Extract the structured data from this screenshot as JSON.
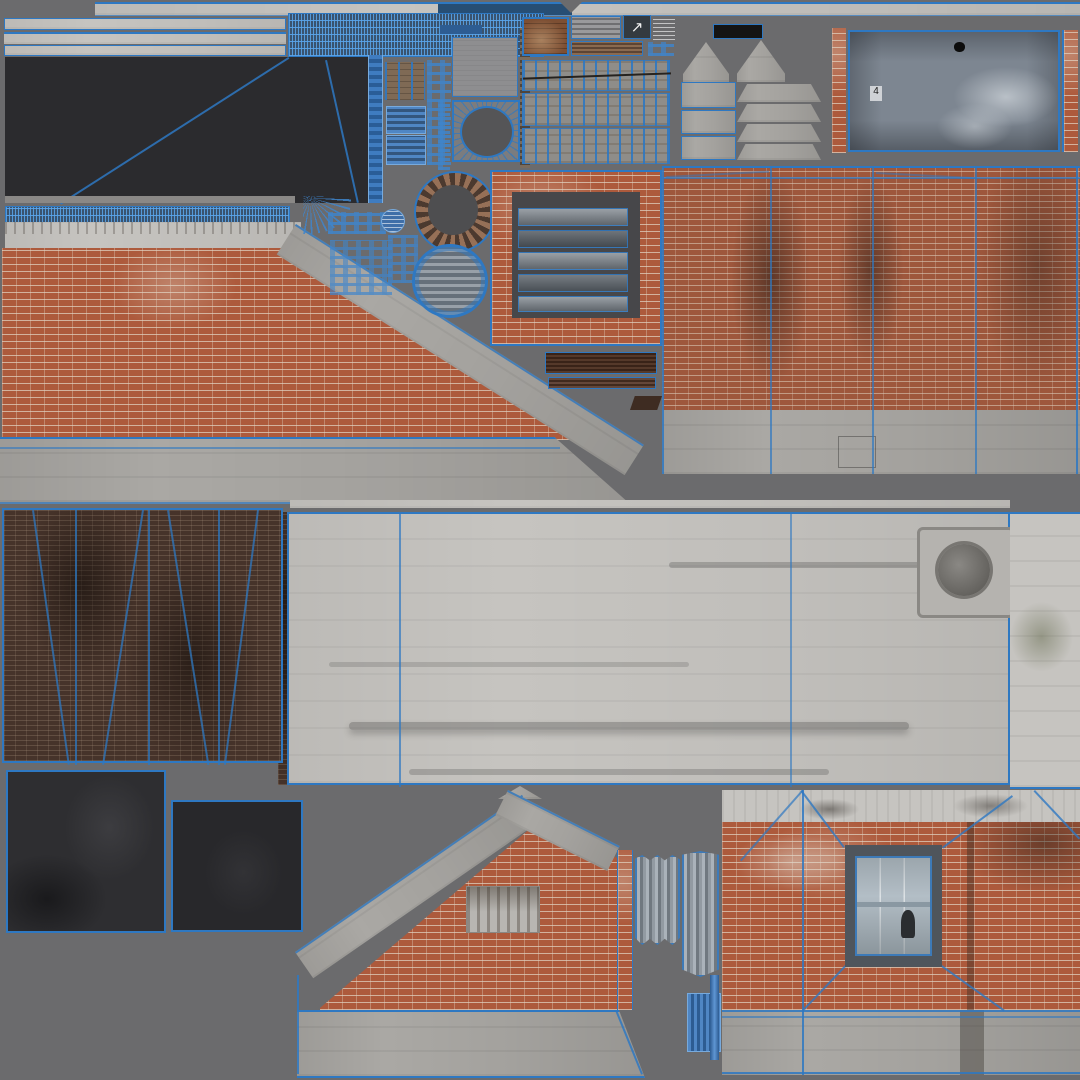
{
  "meta": {
    "kind": "uv-texture-atlas",
    "subject": "weathered brick building exterior texture sheet with blue UV wireframe overlay",
    "canvas_w": 1080,
    "canvas_h": 1080
  },
  "palette": {
    "background": "#6b6b6d",
    "uv_blue": "#2e78c2",
    "uv_blue_soft": "#3d7ab8",
    "dark_panel": "#2b2b2e",
    "brick_red": "#ad5a3c",
    "brick_dark": "#46332a",
    "brick_rust": "#7d4f33",
    "concrete_light": "#c6c4c0",
    "concrete_mid": "#aaa8a4",
    "slab_gray_blue": "#7d8691",
    "metal_blue": "#4f86c4",
    "metal_dark": "#2d5c92",
    "corrugated_light": "#aab2ba",
    "corrugated_dark": "#707880",
    "window_frame": "#4f555c",
    "window_glass": "#b3bec6",
    "black_panel": "#141414",
    "dark_square": "#2e2e31"
  },
  "labels": {
    "slab_number": "4"
  },
  "icons": {
    "arrow_up_right": "↗"
  },
  "islands": [
    {
      "name": "roof-trim-strips",
      "kind": "concrete"
    },
    {
      "name": "uv-wire-band",
      "kind": "wireframe"
    },
    {
      "name": "dark-backdrop-panel",
      "kind": "shadow"
    },
    {
      "name": "louver-and-plank-panels",
      "kind": "metal-wood"
    },
    {
      "name": "round-vent-ring",
      "kind": "wireframe"
    },
    {
      "name": "louver-disc",
      "kind": "metal"
    },
    {
      "name": "brick-framed-wall-vent",
      "kind": "brick-metal"
    },
    {
      "name": "awning-trapezoids",
      "kind": "concrete"
    },
    {
      "name": "gray-blue-slab",
      "kind": "concrete"
    },
    {
      "name": "left-roof-parapet-wall",
      "kind": "brick-concrete"
    },
    {
      "name": "right-brick-wall",
      "kind": "brick-concrete"
    },
    {
      "name": "center-concrete-wall",
      "kind": "concrete"
    },
    {
      "name": "dark-brown-brick-wall",
      "kind": "brick"
    },
    {
      "name": "dark-floor-squares",
      "kind": "asphalt"
    },
    {
      "name": "gable-brick-wall",
      "kind": "brick-concrete"
    },
    {
      "name": "corrugated-door-panels",
      "kind": "metal"
    },
    {
      "name": "front-wall-with-window",
      "kind": "brick-concrete"
    }
  ]
}
